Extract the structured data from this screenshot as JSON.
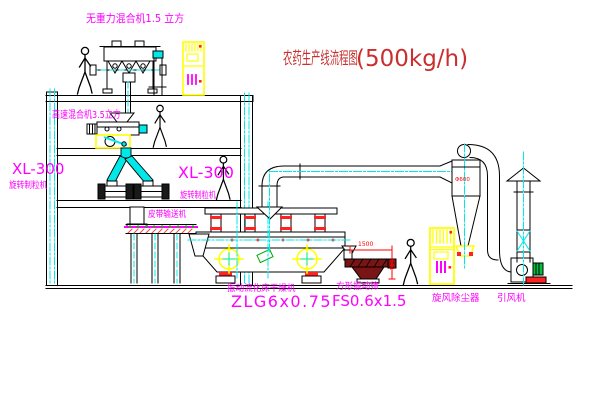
{
  "title": {
    "text": "农药生产线流程图",
    "capacity": "(500kg/h)"
  },
  "labels": {
    "gravity_mixer": "无重力混合机1.5 立方",
    "high_speed_mixer": "高速混合机3.5立方",
    "granulator_left_model": "XL-300",
    "granulator_left_name": "旋转制粒机",
    "granulator_right_model": "XL-300",
    "granulator_right_name": "旋转制粒机",
    "belt_conveyor": "皮带输送机",
    "dryer_name": "振动流化床干燥机",
    "dryer_model": "ZLG6x0.75",
    "screen_name": "方形振动筛",
    "screen_model": "FS0.6x1.5",
    "cyclone": "旋风除尘器",
    "fan": "引风机"
  },
  "dims": {
    "cyclone_diameter": "Φ600",
    "screen_length": "1500",
    "screen_outlet_height": "541"
  },
  "colors": {
    "line": "#000000",
    "label_magenta": "#ff00ff",
    "title_red": "#c92f2f",
    "accent_red": "#ff2222",
    "centerline_cyan": "#00e8e8",
    "highlight_yellow": "#ffff00",
    "motor_green": "#00c040",
    "screen_maroon": "#7a1515",
    "background": "#ffffff"
  },
  "figures": {
    "people_count": 4
  }
}
